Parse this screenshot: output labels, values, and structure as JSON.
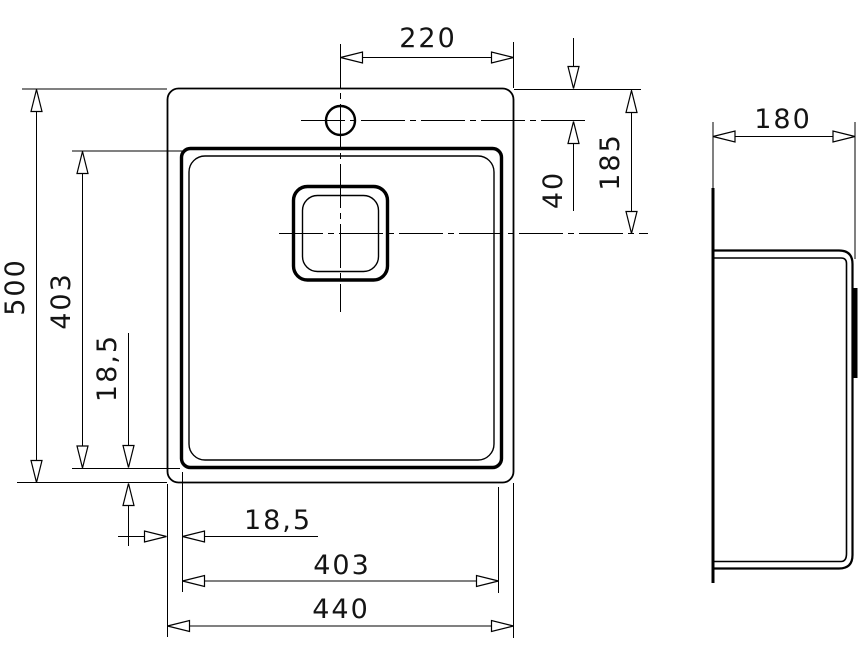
{
  "drawing": {
    "kind": "sink-installation-technical-drawing",
    "views": {
      "plan": {
        "dims": {
          "faucet_to_right_edge": "220",
          "rim_to_faucet_center": "40",
          "rim_to_drain_center": "185",
          "overall_length": "500",
          "bowl_length": "403",
          "rim_to_bowl_inset_vertical": "18,5",
          "rim_to_bowl_inset_horizontal": "18,5",
          "bowl_width": "403",
          "overall_width": "440"
        }
      },
      "side": {
        "dims": {
          "bowl_depth": "180"
        }
      }
    }
  }
}
